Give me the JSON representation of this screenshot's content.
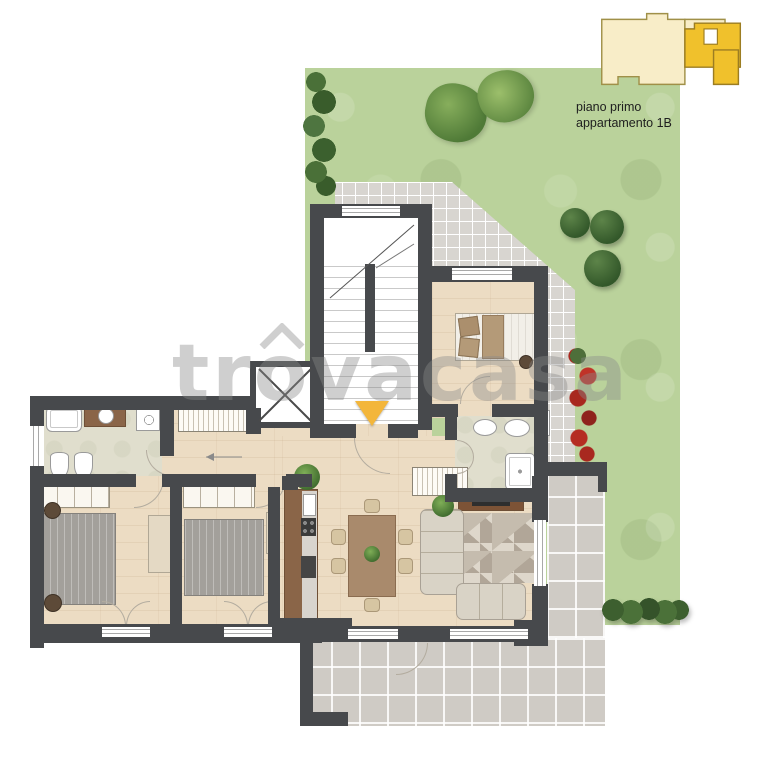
{
  "legend": {
    "floor_label": "piano primo",
    "apartment_label": "appartamento 1B"
  },
  "watermark": {
    "part1": "tr",
    "letter_o": "o",
    "part2": "vacasa"
  },
  "palette": {
    "lawn_green": "#bad29b",
    "small_tile_gray": "#d8d5d0",
    "large_tile_gray": "#cfcbc5",
    "wall_dark": "#47494c",
    "wood_floor": "#ecdcc3",
    "bath_floor": "#e0decd",
    "entry_arrow_yellow": "#f3b63b",
    "legend_pale_yellow": "#f8edc8",
    "legend_gold": "#f0c12c",
    "rose_red": "#b23026",
    "tree_green": "#3f6b33",
    "watermark_gray": "#8a8a8a"
  },
  "plan_features": [
    "staircase",
    "elevator",
    "entrance-arrow",
    "double-bed",
    "double-bed",
    "double-bed",
    "sofa",
    "dining-table",
    "kitchen",
    "bathtub",
    "shower",
    "toilet",
    "bidet",
    "washing-machine",
    "wardrobe",
    "garden-lawn",
    "hedge",
    "round-trees",
    "rose-bushes",
    "terrace",
    "patio"
  ]
}
